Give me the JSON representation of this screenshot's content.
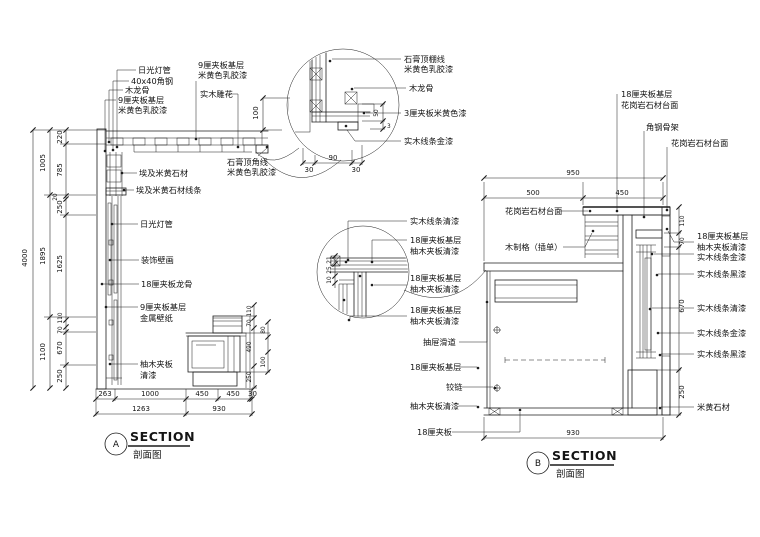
{
  "meta": {
    "bg": "#ffffff",
    "ink": "#1c1c1c"
  },
  "section_a": {
    "bubble": "A",
    "title": "SECTION",
    "subtitle": "剖面图",
    "labels": {
      "l1": "日光灯管",
      "l2": "40x40角钢",
      "l3": "木龙骨",
      "l4a": "9厘夹板基层",
      "l4b": "米黄色乳胶漆",
      "l5a": "9厘夹板基层",
      "l5b": "米黄色乳胶漆",
      "l6": "实木雕花",
      "l7a": "石膏顶角线",
      "l7b": "米黄色乳胶漆",
      "l8": "埃及米黄石材",
      "l9": "埃及米黄石材线条",
      "l10": "日光灯管",
      "l11": "装饰壁画",
      "l12": "18厘夹板龙骨",
      "l13a": "9厘夹板基层",
      "l13b": "金属壁纸",
      "l14a": "柚木夹板",
      "l14b": "清漆"
    },
    "dims": {
      "total": "4000",
      "mid": [
        "1005",
        "1895",
        "1100"
      ],
      "inner": [
        "220",
        "785",
        "20",
        "250",
        "1625",
        "110",
        "70",
        "670",
        "250"
      ],
      "bottom1": [
        "263",
        "1000",
        "450",
        "450",
        "30"
      ],
      "bottom2": [
        "1263",
        "930"
      ],
      "cabinet": [
        "110",
        "70",
        "80",
        "490",
        "100",
        "250"
      ]
    }
  },
  "detail_a": {
    "labels": {
      "d1a": "石膏顶棚线",
      "d1b": "米黄色乳胶漆",
      "d2": "木龙骨",
      "d3": "3厘夹板米黄色漆",
      "d4": "实木线条金漆"
    },
    "dims": {
      "h": "100",
      "t": "50",
      "t2": "3",
      "w": "90",
      "w1": "30",
      "w2": "30"
    }
  },
  "section_b": {
    "bubble": "B",
    "title": "SECTION",
    "subtitle": "剖面图",
    "labels": {
      "t1a": "18厘夹板基层",
      "t1b": "花岗岩石材台面",
      "t2": "角钢骨架",
      "t3": "花岗岩石材台面",
      "t4": "花岗岩石材台面",
      "t5": "木制格（插单）",
      "m1": "实木线条清漆",
      "m2a": "18厘夹板基层",
      "m2b": "柚木夹板清漆",
      "m3a": "18厘夹板基层",
      "m3b": "柚木夹板清漆",
      "m4a": "18厘夹板基层",
      "m4b": "柚木夹板清漆",
      "m5": "抽屉滑道",
      "m6": "18厘夹板基层",
      "m7": "铰链",
      "m8": "柚木夹板清漆",
      "m9": "18厘夹板",
      "r1a": "18厘夹板基层",
      "r1b": "柚木夹板清漆",
      "r2": "实木线条金漆",
      "r3": "实木线条黑漆",
      "r4": "实木线条清漆",
      "r5": "实木线条金漆",
      "r6": "实木线条黑漆",
      "r7": "米黄石材"
    },
    "dims": {
      "top": "950",
      "tl": "500",
      "tr": "450",
      "right": [
        "110",
        "70",
        "670",
        "250"
      ],
      "bottom": "930",
      "detail": [
        "21",
        "25",
        "10"
      ]
    }
  }
}
